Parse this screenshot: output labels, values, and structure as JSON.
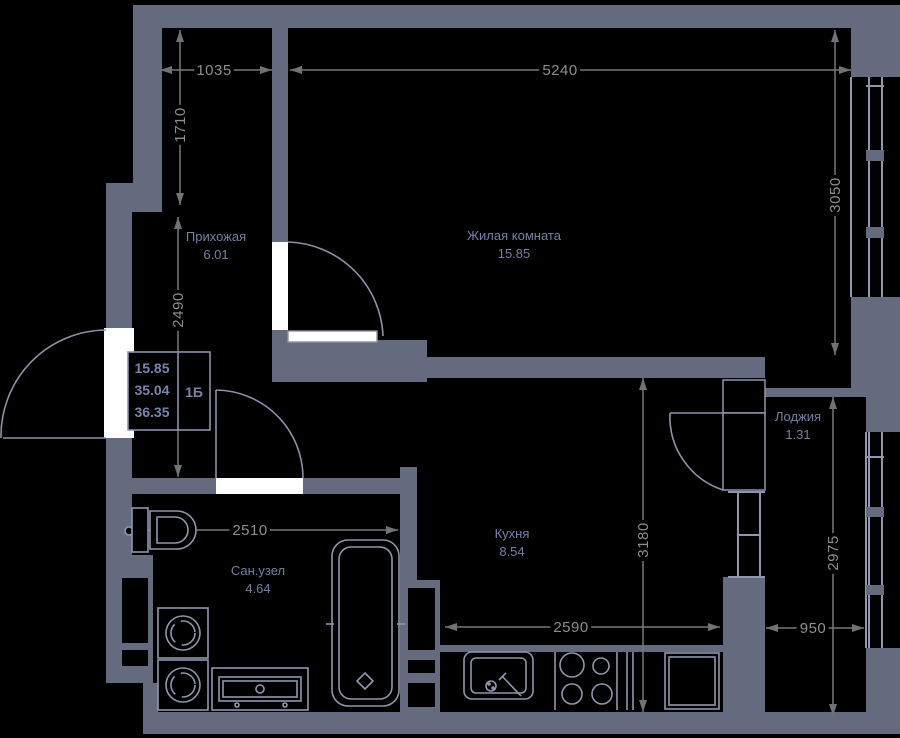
{
  "plan_title": "Планировка квартиры 1Б",
  "rooms": [
    {
      "id": "hallway",
      "name": "Прихожая",
      "area": "6.01"
    },
    {
      "id": "living",
      "name": "Жилая комната",
      "area": "15.85"
    },
    {
      "id": "bathroom",
      "name": "Сан.узел",
      "area": "4.64"
    },
    {
      "id": "kitchen",
      "name": "Кухня",
      "area": "8.54"
    },
    {
      "id": "loggia",
      "name": "Лоджия",
      "area": "1.31"
    }
  ],
  "info_box": {
    "living_area": "15.85",
    "apartment_area": "35.04",
    "total_area": "36.35",
    "unit_label": "1Б"
  },
  "dims": {
    "hall_top_width": "1035",
    "living_width": "5240",
    "hall_upper_height": "1710",
    "hall_lower_height": "2490",
    "living_height": "3050",
    "bath_width": "2510",
    "kitchen_height": "3180",
    "kitchen_width": "2590",
    "loggia_height": "2975",
    "loggia_width": "950"
  },
  "colors": {
    "background": "#000000",
    "wall": "#656B7E",
    "fixture_line": "#9096AE",
    "dimension_text": "#8E8E91",
    "room_label": "#7680A6"
  }
}
